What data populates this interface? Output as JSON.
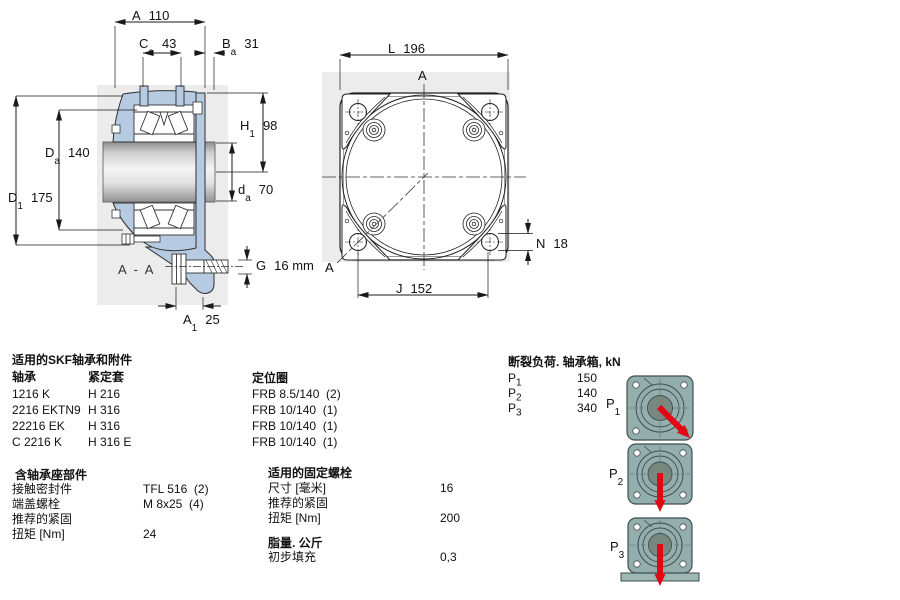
{
  "drawing_left": {
    "section_label": "A - A",
    "dims": {
      "A": {
        "base": "A",
        "value": "110"
      },
      "Ca": {
        "base": "C",
        "sub": "a",
        "value": "43"
      },
      "Ba": {
        "base": "B",
        "sub": "a",
        "value": "31"
      },
      "H1": {
        "base": "H",
        "sub": "1",
        "value": "98"
      },
      "Da": {
        "base": "D",
        "sub": "a",
        "value": "140"
      },
      "da": {
        "base": "d",
        "sub": "a",
        "value": "70"
      },
      "D1": {
        "base": "D",
        "sub": "1",
        "value": "175"
      },
      "G": {
        "base": "G",
        "value": "16 mm"
      },
      "A1": {
        "base": "A",
        "sub": "1",
        "value": "25"
      }
    }
  },
  "drawing_right": {
    "marker_top": "A",
    "marker_bottom": "A",
    "dims": {
      "L": {
        "base": "L",
        "value": "196"
      },
      "J": {
        "base": "J",
        "value": "152"
      },
      "N": {
        "base": "N",
        "value": "18"
      }
    }
  },
  "tables": {
    "bearings": {
      "title": "适用的SKF轴承和附件",
      "col1": "轴承",
      "col2": "紧定套",
      "rows": [
        {
          "c1": "1216 K",
          "c2": "H 216"
        },
        {
          "c1": "2216 EKTN9",
          "c2": "H 316"
        },
        {
          "c1": "22216 EK",
          "c2": "H 316"
        },
        {
          "c1": "C 2216 K",
          "c2": "H 316 E"
        }
      ]
    },
    "locating_rings": {
      "title": "定位圈",
      "rows": [
        {
          "c1": "FRB 8.5/140  (2)"
        },
        {
          "c1": "FRB 10/140  (1)"
        },
        {
          "c1": "FRB 10/140  (1)"
        },
        {
          "c1": "FRB 10/140  (1)"
        }
      ]
    },
    "housing_parts": {
      "title": "含轴承座部件",
      "rows": [
        {
          "c1": "接触密封件",
          "c2": "TFL 516  (2)"
        },
        {
          "c1": "端盖螺栓",
          "c2": "M 8x25  (4)"
        },
        {
          "c1": "推荐的紧固",
          "c2": ""
        },
        {
          "c1": "扭矩 [Nm]",
          "c2": "24"
        }
      ]
    },
    "attachment_bolts": {
      "title": "适用的固定螺栓",
      "rows": [
        {
          "c1": "尺寸 [毫米]",
          "c2": "16"
        },
        {
          "c1": "推荐的紧固",
          "c2": ""
        },
        {
          "c1": "扭矩 [Nm]",
          "c2": "200"
        }
      ]
    },
    "grease": {
      "title": "脂量. 公斤",
      "rows": [
        {
          "c1": "初步填充",
          "c2": "0,3"
        }
      ]
    },
    "breaking_loads": {
      "title": "断裂负荷. 轴承箱, kN",
      "rows": [
        {
          "base": "P",
          "sub": "1",
          "value": "150"
        },
        {
          "base": "P",
          "sub": "2",
          "value": "140"
        },
        {
          "base": "P",
          "sub": "3",
          "value": "340"
        }
      ]
    }
  },
  "load_figures": [
    {
      "base": "P",
      "sub": "1",
      "arrow": "load-arrow-diagonal-down-right"
    },
    {
      "base": "P",
      "sub": "2",
      "arrow": "load-arrow-down"
    },
    {
      "base": "P",
      "sub": "3",
      "arrow": "load-arrow-down-onto-support"
    }
  ],
  "colors": {
    "housing_blue": "#b6cbe2",
    "flange_teal": "#93aeac",
    "flange_center": "#78887f",
    "load_arrow_red": "#e30613",
    "watermark_gray": "#ececec",
    "line": "#1a1a1a"
  }
}
